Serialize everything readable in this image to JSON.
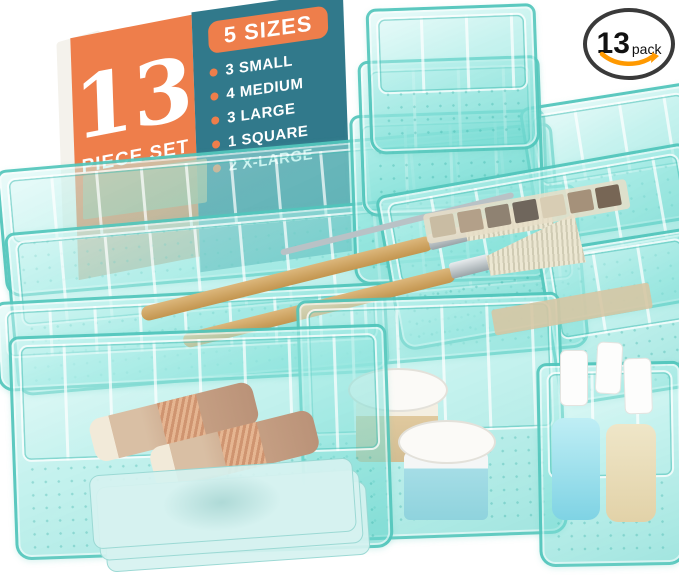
{
  "card": {
    "count": "13",
    "count_label": "PIECE SET",
    "sizes_title": "5 SIZES",
    "sizes": [
      "3 SMALL",
      "4 MEDIUM",
      "3 LARGE",
      "1 SQUARE",
      "2 X-LARGE"
    ],
    "colors": {
      "orange": "#EE7E4B",
      "teal": "#31798B",
      "text": "#FFFFFF"
    }
  },
  "badge": {
    "count": "13",
    "unit": "pack",
    "arrow_color": "#FF9900",
    "border_color": "#3A3A3A"
  },
  "product": {
    "bin_edge_color": "#4DC3B9",
    "bin_fill_color": "rgba(151,232,225,0.55)",
    "bin_counts": {
      "small": 3,
      "medium": 4,
      "large": 3,
      "square": 1,
      "x_large": 2
    },
    "visible_objects": [
      "makeup-brushes",
      "eyeshadow-palette",
      "lipsticks",
      "face-mask-sheets",
      "cream-jars",
      "nail-polish-bottles"
    ],
    "palette_swatches": [
      "#c9bca3",
      "#b3a089",
      "#8f8272",
      "#6f665c",
      "#d8cdb4",
      "#a5917a",
      "#776655"
    ]
  }
}
